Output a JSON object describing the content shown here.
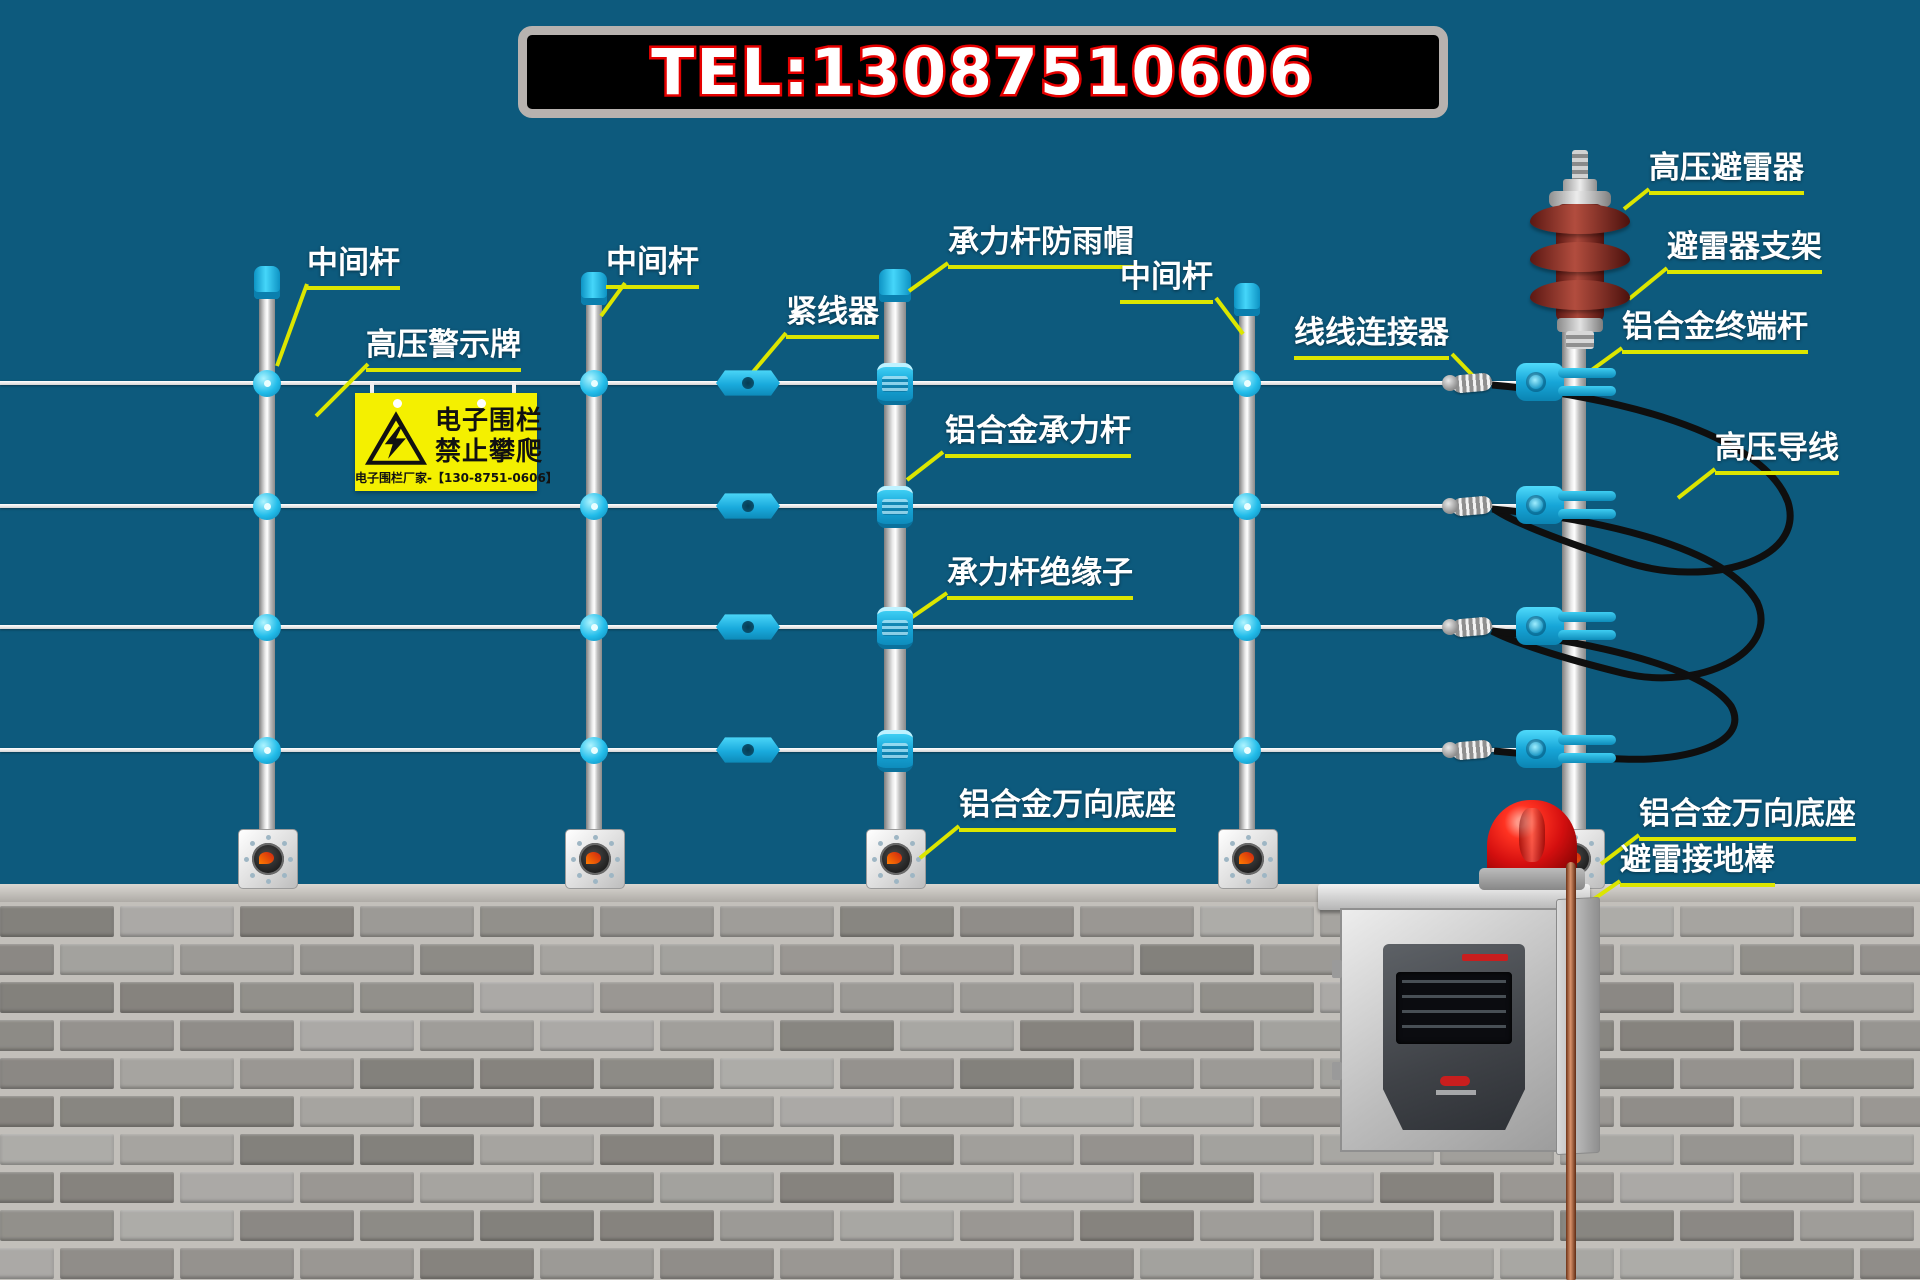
{
  "banner": {
    "tel": "TEL:13087510606"
  },
  "labels": {
    "mid_pole_1": "中间杆",
    "warning_board": "高压警示牌",
    "mid_pole_2": "中间杆",
    "tensioner": "紧线器",
    "rain_cap": "承力杆防雨帽",
    "load_pole": "铝合金承力杆",
    "load_pole_insulator": "承力杆绝缘子",
    "mid_pole_3": "中间杆",
    "wire_connector": "线线连接器",
    "arrester": "高压避雷器",
    "arrester_bracket": "避雷器支架",
    "terminal_pole": "铝合金终端杆",
    "hv_lead_wire": "高压导线",
    "universal_base_mid": "铝合金万向底座",
    "universal_base_right": "铝合金万向底座",
    "ground_rod": "避雷接地棒"
  },
  "warning_sign": {
    "line1": "电子围栏",
    "line2": "禁止攀爬",
    "footer": "电子围栏厂家-【130-8751-0606】"
  },
  "colors": {
    "background": "#0d5a7d",
    "accent_cyan": "#1cb8e8",
    "label_line": "#dce600",
    "sign_yellow": "#f4f000",
    "banner_red": "#e60000",
    "arrester_red": "#8c2f24"
  }
}
